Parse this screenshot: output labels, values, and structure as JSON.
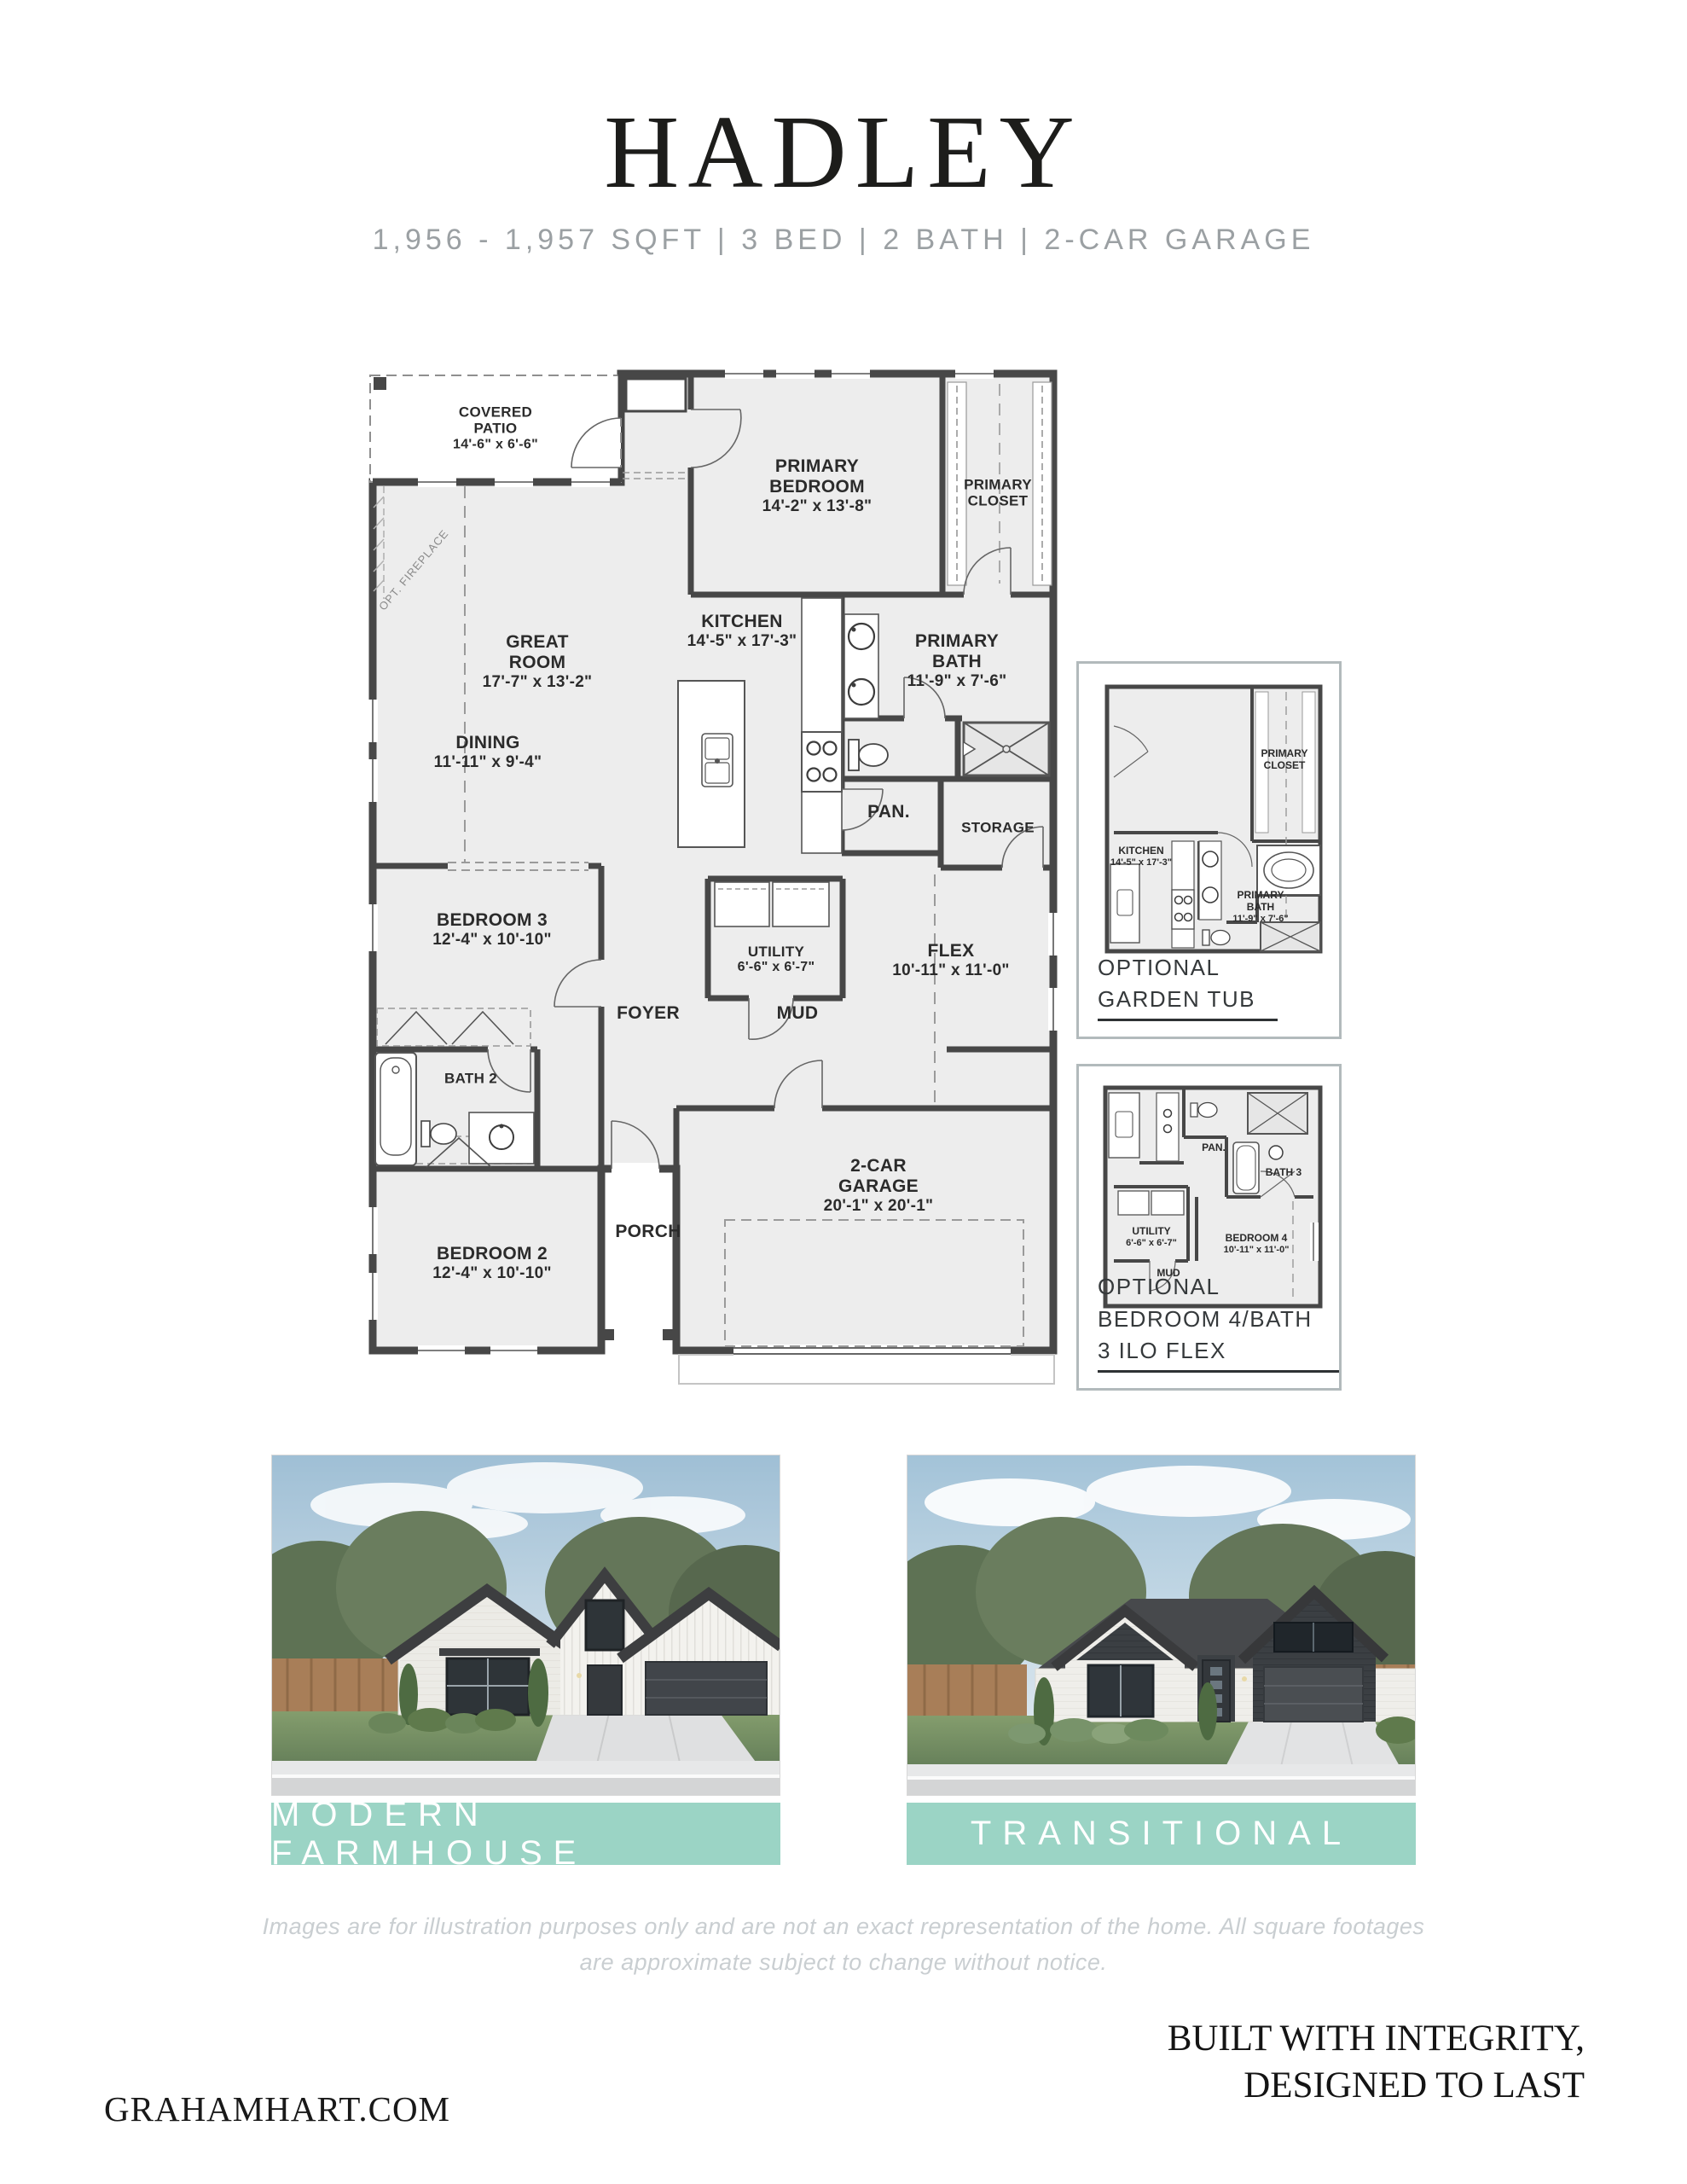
{
  "header": {
    "title": "HADLEY",
    "subtitle": "1,956 - 1,957 SQFT | 3 BED | 2 BATH | 2-CAR GARAGE"
  },
  "floor_plan": {
    "opt_fireplace_label": "OPT. FIREPLACE",
    "rooms": {
      "covered_patio": {
        "line1": "COVERED",
        "line2": "PATIO",
        "dims": "14'-6\" x 6'-6\""
      },
      "primary_bedroom": {
        "line1": "PRIMARY",
        "line2": "BEDROOM",
        "dims": "14'-2\" x 13'-8\""
      },
      "primary_closet": {
        "line1": "PRIMARY",
        "line2": "CLOSET"
      },
      "great_room": {
        "line1": "GREAT",
        "line2": "ROOM",
        "dims": "17'-7\" x 13'-2\""
      },
      "kitchen": {
        "line1": "KITCHEN",
        "dims": "14'-5\" x 17'-3\""
      },
      "primary_bath": {
        "line1": "PRIMARY",
        "line2": "BATH",
        "dims": "11'-9\" x 7'-6\""
      },
      "dining": {
        "line1": "DINING",
        "dims": "11'-11\" x 9'-4\""
      },
      "pantry": {
        "line1": "PAN."
      },
      "storage": {
        "line1": "STORAGE"
      },
      "bedroom_3": {
        "line1": "BEDROOM 3",
        "dims": "12'-4\" x 10'-10\""
      },
      "utility": {
        "line1": "UTILITY",
        "dims": "6'-6\" x 6'-7\""
      },
      "flex": {
        "line1": "FLEX",
        "dims": "10'-11\" x 11'-0\""
      },
      "foyer": {
        "line1": "FOYER"
      },
      "mud": {
        "line1": "MUD"
      },
      "bath_2": {
        "line1": "BATH 2"
      },
      "garage": {
        "line1": "2-CAR",
        "line2": "GARAGE",
        "dims": "20'-1\" x 20'-1\""
      },
      "porch": {
        "line1": "PORCH"
      },
      "bedroom_2": {
        "line1": "BEDROOM 2",
        "dims": "12'-4\" x 10'-10\""
      }
    }
  },
  "insets": {
    "garden_tub": {
      "caption_line1": "OPTIONAL",
      "caption_line2": "GARDEN TUB",
      "rooms": {
        "kitchen": {
          "line1": "KITCHEN",
          "dims": "14'-5\" x 17'-3\""
        },
        "primary_closet": {
          "line1": "PRIMARY",
          "line2": "CLOSET"
        },
        "primary_bath": {
          "line1": "PRIMARY",
          "line2": "BATH",
          "dims": "11'-9\" x 7'-6\""
        }
      }
    },
    "bedroom4_flex": {
      "caption_line1": "OPTIONAL",
      "caption_line2": "BEDROOM 4/BATH 3 ILO FLEX",
      "rooms": {
        "pantry": {
          "line1": "PAN."
        },
        "bath_3": {
          "line1": "BATH 3"
        },
        "utility": {
          "line1": "UTILITY",
          "dims": "6'-6\" x 6'-7\""
        },
        "bedroom_4": {
          "line1": "BEDROOM 4",
          "dims": "10'-11\" x 11'-0\""
        },
        "mud": {
          "line1": "MUD"
        }
      }
    }
  },
  "elevations": [
    {
      "caption": "MODERN FARMHOUSE"
    },
    {
      "caption": "TRANSITIONAL"
    }
  ],
  "disclaimer": "Images are for illustration purposes only and are not an exact representation of the home. All square footages are approximate subject to change without notice.",
  "footer": {
    "website": "GRAHAMHART.COM",
    "tagline_line1": "BUILT WITH INTEGRITY,",
    "tagline_line2": "DESIGNED TO LAST"
  },
  "colors": {
    "accent_teal": "#9bd4c5",
    "plan_floor": "#ededed",
    "plan_wall": "#474747",
    "title_text": "#1d1d1b",
    "subtitle_text": "#9ba0a3",
    "disclaimer_text": "#c9ced1"
  }
}
